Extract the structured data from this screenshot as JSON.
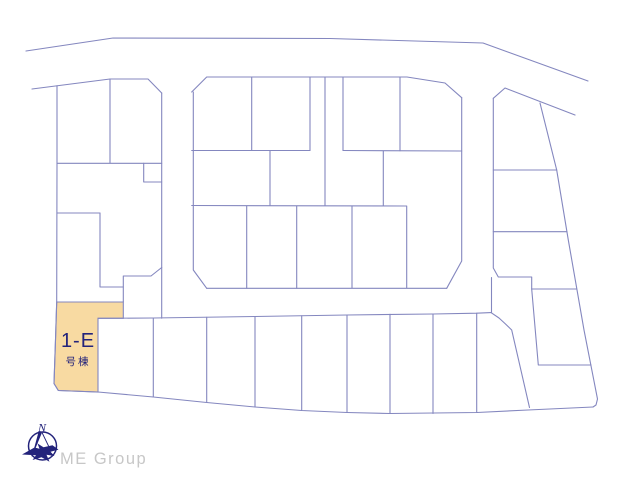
{
  "colors": {
    "line": "#8487BF",
    "navy": "#23237B",
    "tan": "#F8DAA2",
    "gray": "#C7C7C7",
    "bg": "#FFFFFF"
  },
  "highlighted_lot": {
    "label": "1-E",
    "sublabel": "号棟"
  },
  "branding": {
    "company": "ME Group",
    "compass_north": "N",
    "compass_icon": "compass-with-bird-silhouette"
  },
  "map": {
    "width": 640,
    "height": 480,
    "stroke_width": 1.1,
    "highlight_polygon": [
      [
        56.7,
        302
      ],
      [
        123.3,
        302
      ],
      [
        123.3,
        318.3
      ],
      [
        98,
        318.3
      ],
      [
        98,
        392
      ],
      [
        58.3,
        390.5
      ],
      [
        54,
        383.5
      ],
      [
        55.5,
        340
      ]
    ],
    "polylines": [
      [
        [
          26,
          51
        ],
        [
          113,
          38
        ],
        [
          330,
          38.5
        ],
        [
          483,
          43
        ],
        [
          588,
          81
        ]
      ],
      [
        [
          32,
          89
        ],
        [
          110,
          79
        ],
        [
          148,
          79
        ],
        [
          161.7,
          93
        ]
      ],
      [
        [
          191.7,
          92
        ],
        [
          206.7,
          77
        ],
        [
          407,
          77
        ],
        [
          445,
          83
        ],
        [
          461.7,
          97.7
        ]
      ],
      [
        [
          493.3,
          98.3
        ],
        [
          505,
          88
        ],
        [
          575,
          115
        ]
      ],
      [
        [
          540,
          103
        ],
        [
          556.7,
          170
        ],
        [
          568.3,
          240
        ],
        [
          584,
          330
        ],
        [
          597.5,
          399
        ],
        [
          596,
          405
        ],
        [
          593,
          407
        ]
      ],
      [
        [
          593,
          407
        ],
        [
          528,
          410
        ],
        [
          477,
          412.5
        ],
        [
          390,
          413.5
        ],
        [
          347,
          412.5
        ],
        [
          301.7,
          410.5
        ],
        [
          255,
          407
        ],
        [
          206.7,
          402.5
        ],
        [
          153.3,
          397
        ],
        [
          98,
          392
        ],
        [
          58.3,
          390.5
        ],
        [
          54,
          383.5
        ]
      ],
      [
        [
          54,
          383.5
        ],
        [
          55.5,
          340
        ],
        [
          56.7,
          302
        ],
        [
          57,
          163.3
        ],
        [
          57,
          85.8
        ]
      ],
      [
        [
          161.7,
          93
        ],
        [
          161.7,
          318.2
        ]
      ],
      [
        [
          193.3,
          92
        ],
        [
          193.3,
          270
        ],
        [
          206.7,
          288.3
        ]
      ],
      [
        [
          461.7,
          97.7
        ],
        [
          461.7,
          261
        ],
        [
          446.7,
          288.3
        ]
      ],
      [
        [
          493.3,
          98.3
        ],
        [
          493.3,
          268
        ],
        [
          498.3,
          277
        ],
        [
          531.7,
          277
        ],
        [
          531.7,
          289
        ]
      ],
      [
        [
          531.7,
          289
        ],
        [
          576.5,
          289
        ]
      ],
      [
        [
          531.7,
          289
        ],
        [
          538.3,
          365
        ],
        [
          591,
          365
        ]
      ],
      [
        [
          206.7,
          288.3
        ],
        [
          446.7,
          288.3
        ]
      ],
      [
        [
          98,
          318.3
        ],
        [
          153.3,
          318
        ],
        [
          255,
          316.5
        ],
        [
          347,
          315
        ],
        [
          433,
          314
        ],
        [
          476.7,
          313.2
        ],
        [
          491,
          312.6
        ]
      ],
      [
        [
          491.5,
          277.5
        ],
        [
          491.5,
          312.6
        ]
      ],
      [
        [
          491,
          312.6
        ],
        [
          499,
          318
        ],
        [
          505.5,
          324
        ],
        [
          511.7,
          330
        ],
        [
          529.5,
          407.5
        ]
      ],
      [
        [
          493.3,
          170
        ],
        [
          556.7,
          170
        ]
      ],
      [
        [
          493.3,
          231.7
        ],
        [
          567,
          231.7
        ]
      ],
      [
        [
          110,
          79
        ],
        [
          110,
          162.8
        ]
      ],
      [
        [
          57,
          163.3
        ],
        [
          161.7,
          163.3
        ]
      ],
      [
        [
          143.7,
          163.3
        ],
        [
          143.7,
          182
        ],
        [
          161.7,
          182
        ]
      ],
      [
        [
          57,
          213
        ],
        [
          100,
          213
        ]
      ],
      [
        [
          100,
          213
        ],
        [
          100,
          287
        ],
        [
          123.3,
          287
        ]
      ],
      [
        [
          123.3,
          302
        ],
        [
          123.3,
          276
        ],
        [
          151,
          276
        ],
        [
          161.7,
          267.5
        ]
      ],
      [
        [
          251.7,
          77
        ],
        [
          251.7,
          150.5
        ]
      ],
      [
        [
          310,
          77
        ],
        [
          310,
          150.5
        ]
      ],
      [
        [
          325,
          77
        ],
        [
          325,
          205.5
        ]
      ],
      [
        [
          343,
          77.3
        ],
        [
          343,
          150.5
        ]
      ],
      [
        [
          400,
          77.3
        ],
        [
          400,
          150.8
        ]
      ],
      [
        [
          191.7,
          150.5
        ],
        [
          310,
          150.5
        ]
      ],
      [
        [
          343,
          150.5
        ],
        [
          461.7,
          151
        ]
      ],
      [
        [
          270,
          150.5
        ],
        [
          270,
          205.5
        ]
      ],
      [
        [
          383.3,
          151
        ],
        [
          383.3,
          205.8
        ]
      ],
      [
        [
          191.7,
          205.5
        ],
        [
          406.7,
          206
        ],
        [
          406.7,
          287.7
        ]
      ],
      [
        [
          246.7,
          206
        ],
        [
          246.7,
          288.3
        ]
      ],
      [
        [
          296.7,
          206
        ],
        [
          296.7,
          288.3
        ]
      ],
      [
        [
          352,
          206
        ],
        [
          352,
          288
        ]
      ],
      [
        [
          153.3,
          318
        ],
        [
          153.3,
          397
        ]
      ],
      [
        [
          206.7,
          317.3
        ],
        [
          206.7,
          402.5
        ]
      ],
      [
        [
          255,
          316.5
        ],
        [
          255,
          407
        ]
      ],
      [
        [
          301.7,
          315.8
        ],
        [
          301.7,
          410.5
        ]
      ],
      [
        [
          347,
          315
        ],
        [
          347,
          412.5
        ]
      ],
      [
        [
          390,
          314.3
        ],
        [
          390,
          413.5
        ]
      ],
      [
        [
          433,
          314
        ],
        [
          433,
          413.5
        ]
      ],
      [
        [
          476.7,
          313.2
        ],
        [
          476.7,
          412.5
        ]
      ]
    ]
  }
}
